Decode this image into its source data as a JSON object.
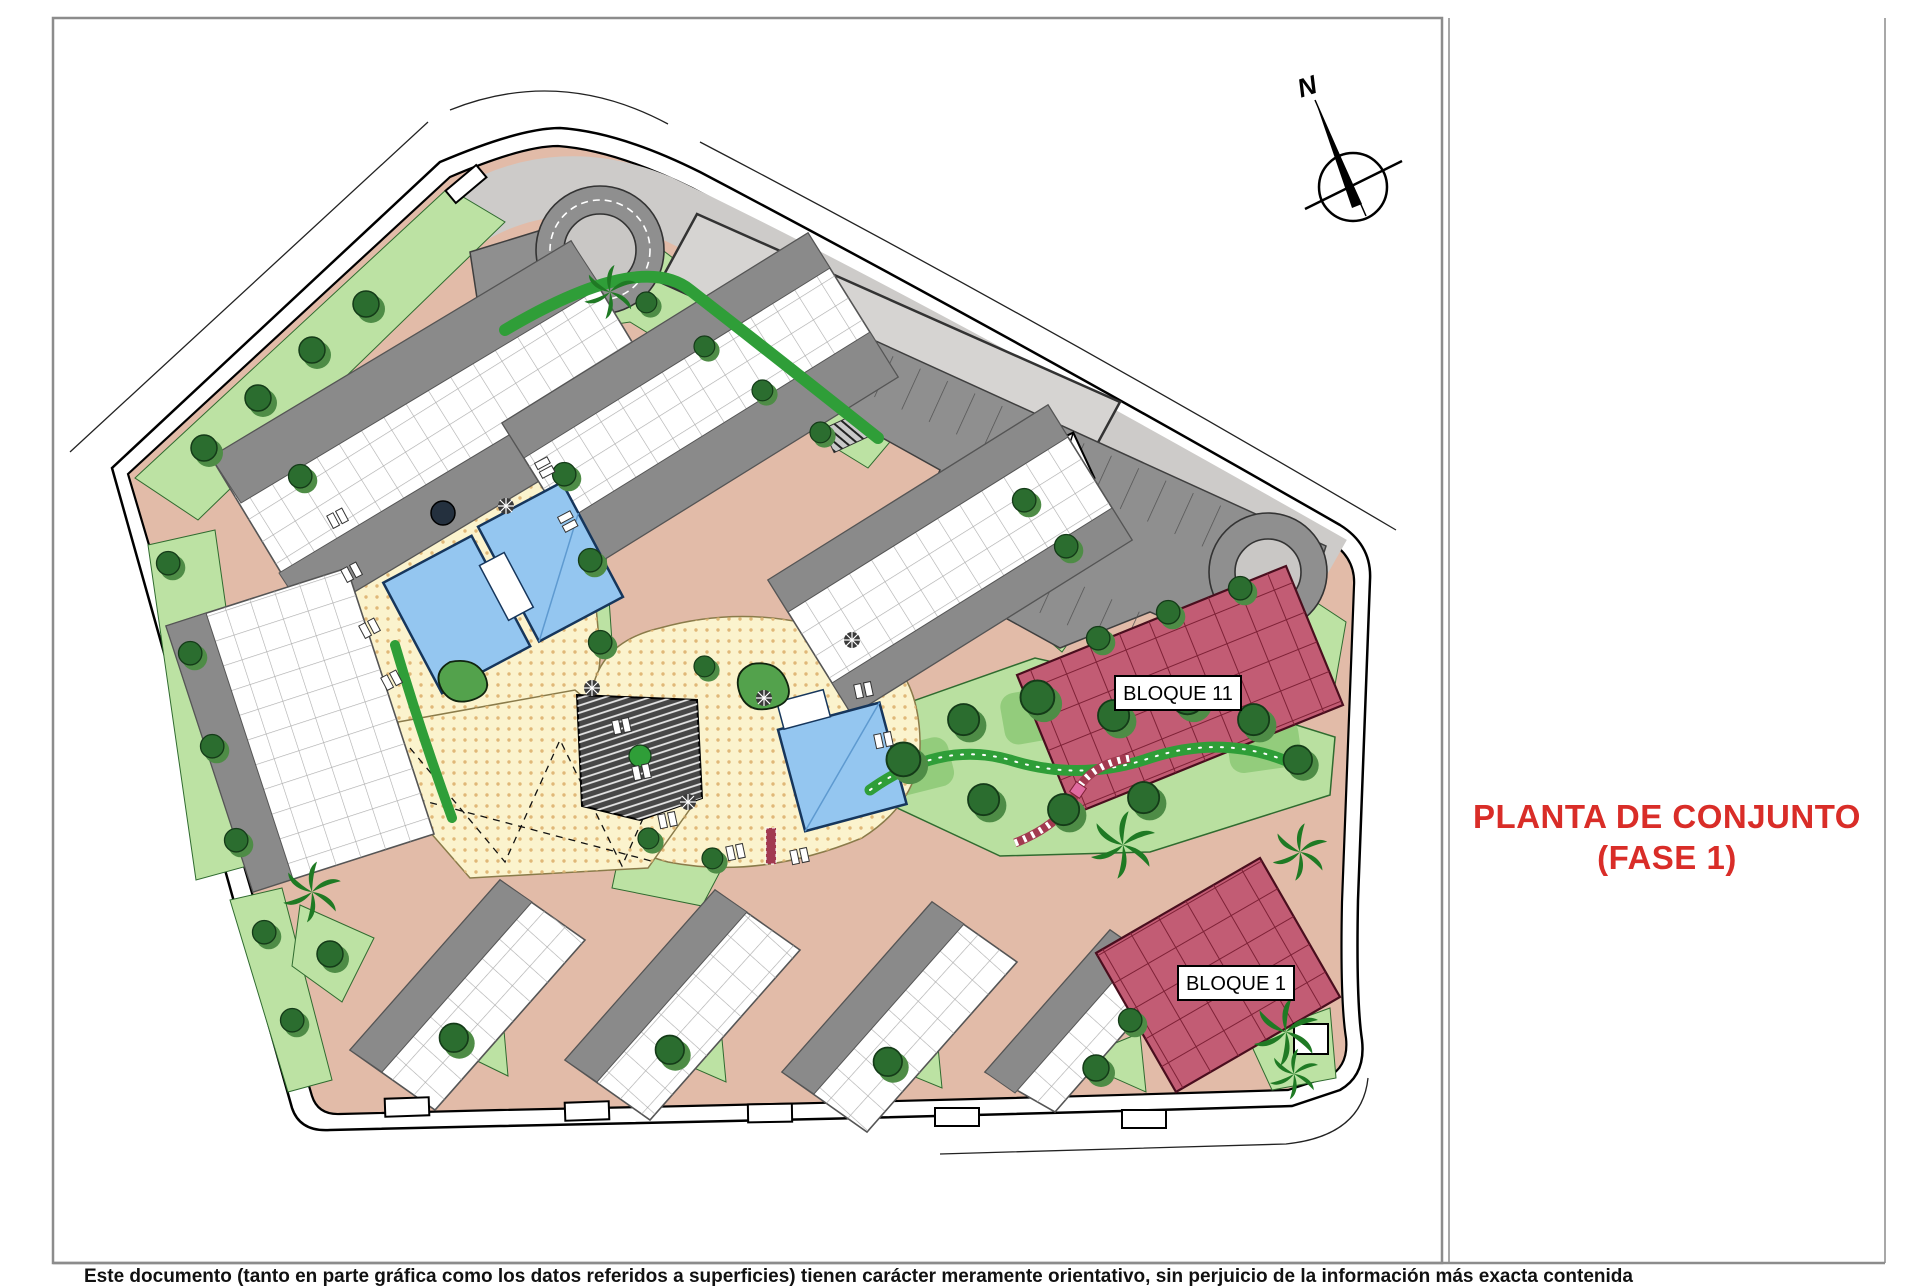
{
  "sheet": {
    "title": {
      "line1": "PLANTA DE CONJUNTO",
      "line2": "(FASE 1)",
      "color": "#D92D28"
    },
    "disclaimer": "Este documento (tanto en parte gráfica como los datos referidos a superficies) tienen carácter meramente orientativo, sin perjuicio de la información más exacta contenida",
    "compass_label": "N"
  },
  "plan": {
    "blocks": [
      {
        "label": "BLOQUE 11"
      },
      {
        "label": "BLOQUE 1"
      }
    ],
    "colors": {
      "road_salmon": "#E2BBA8",
      "lawn_light": "#BCE2A3",
      "lawn_mid": "#93CC7C",
      "hedge_green": "#2F9E38",
      "tree_green": "#2B6D2F",
      "deck_cream": "#FBF3CD",
      "pool_blue": "#94C6F0",
      "block_red": "#C25C74",
      "roof_gray": "#8A8A8A",
      "parking_gray": "#8F8F8F",
      "podium_gray": "#D6D4D2",
      "road_gray": "#CDCBC9",
      "amphitheater_dark": "#474747",
      "frame_gray": "#8C8C8C"
    }
  }
}
